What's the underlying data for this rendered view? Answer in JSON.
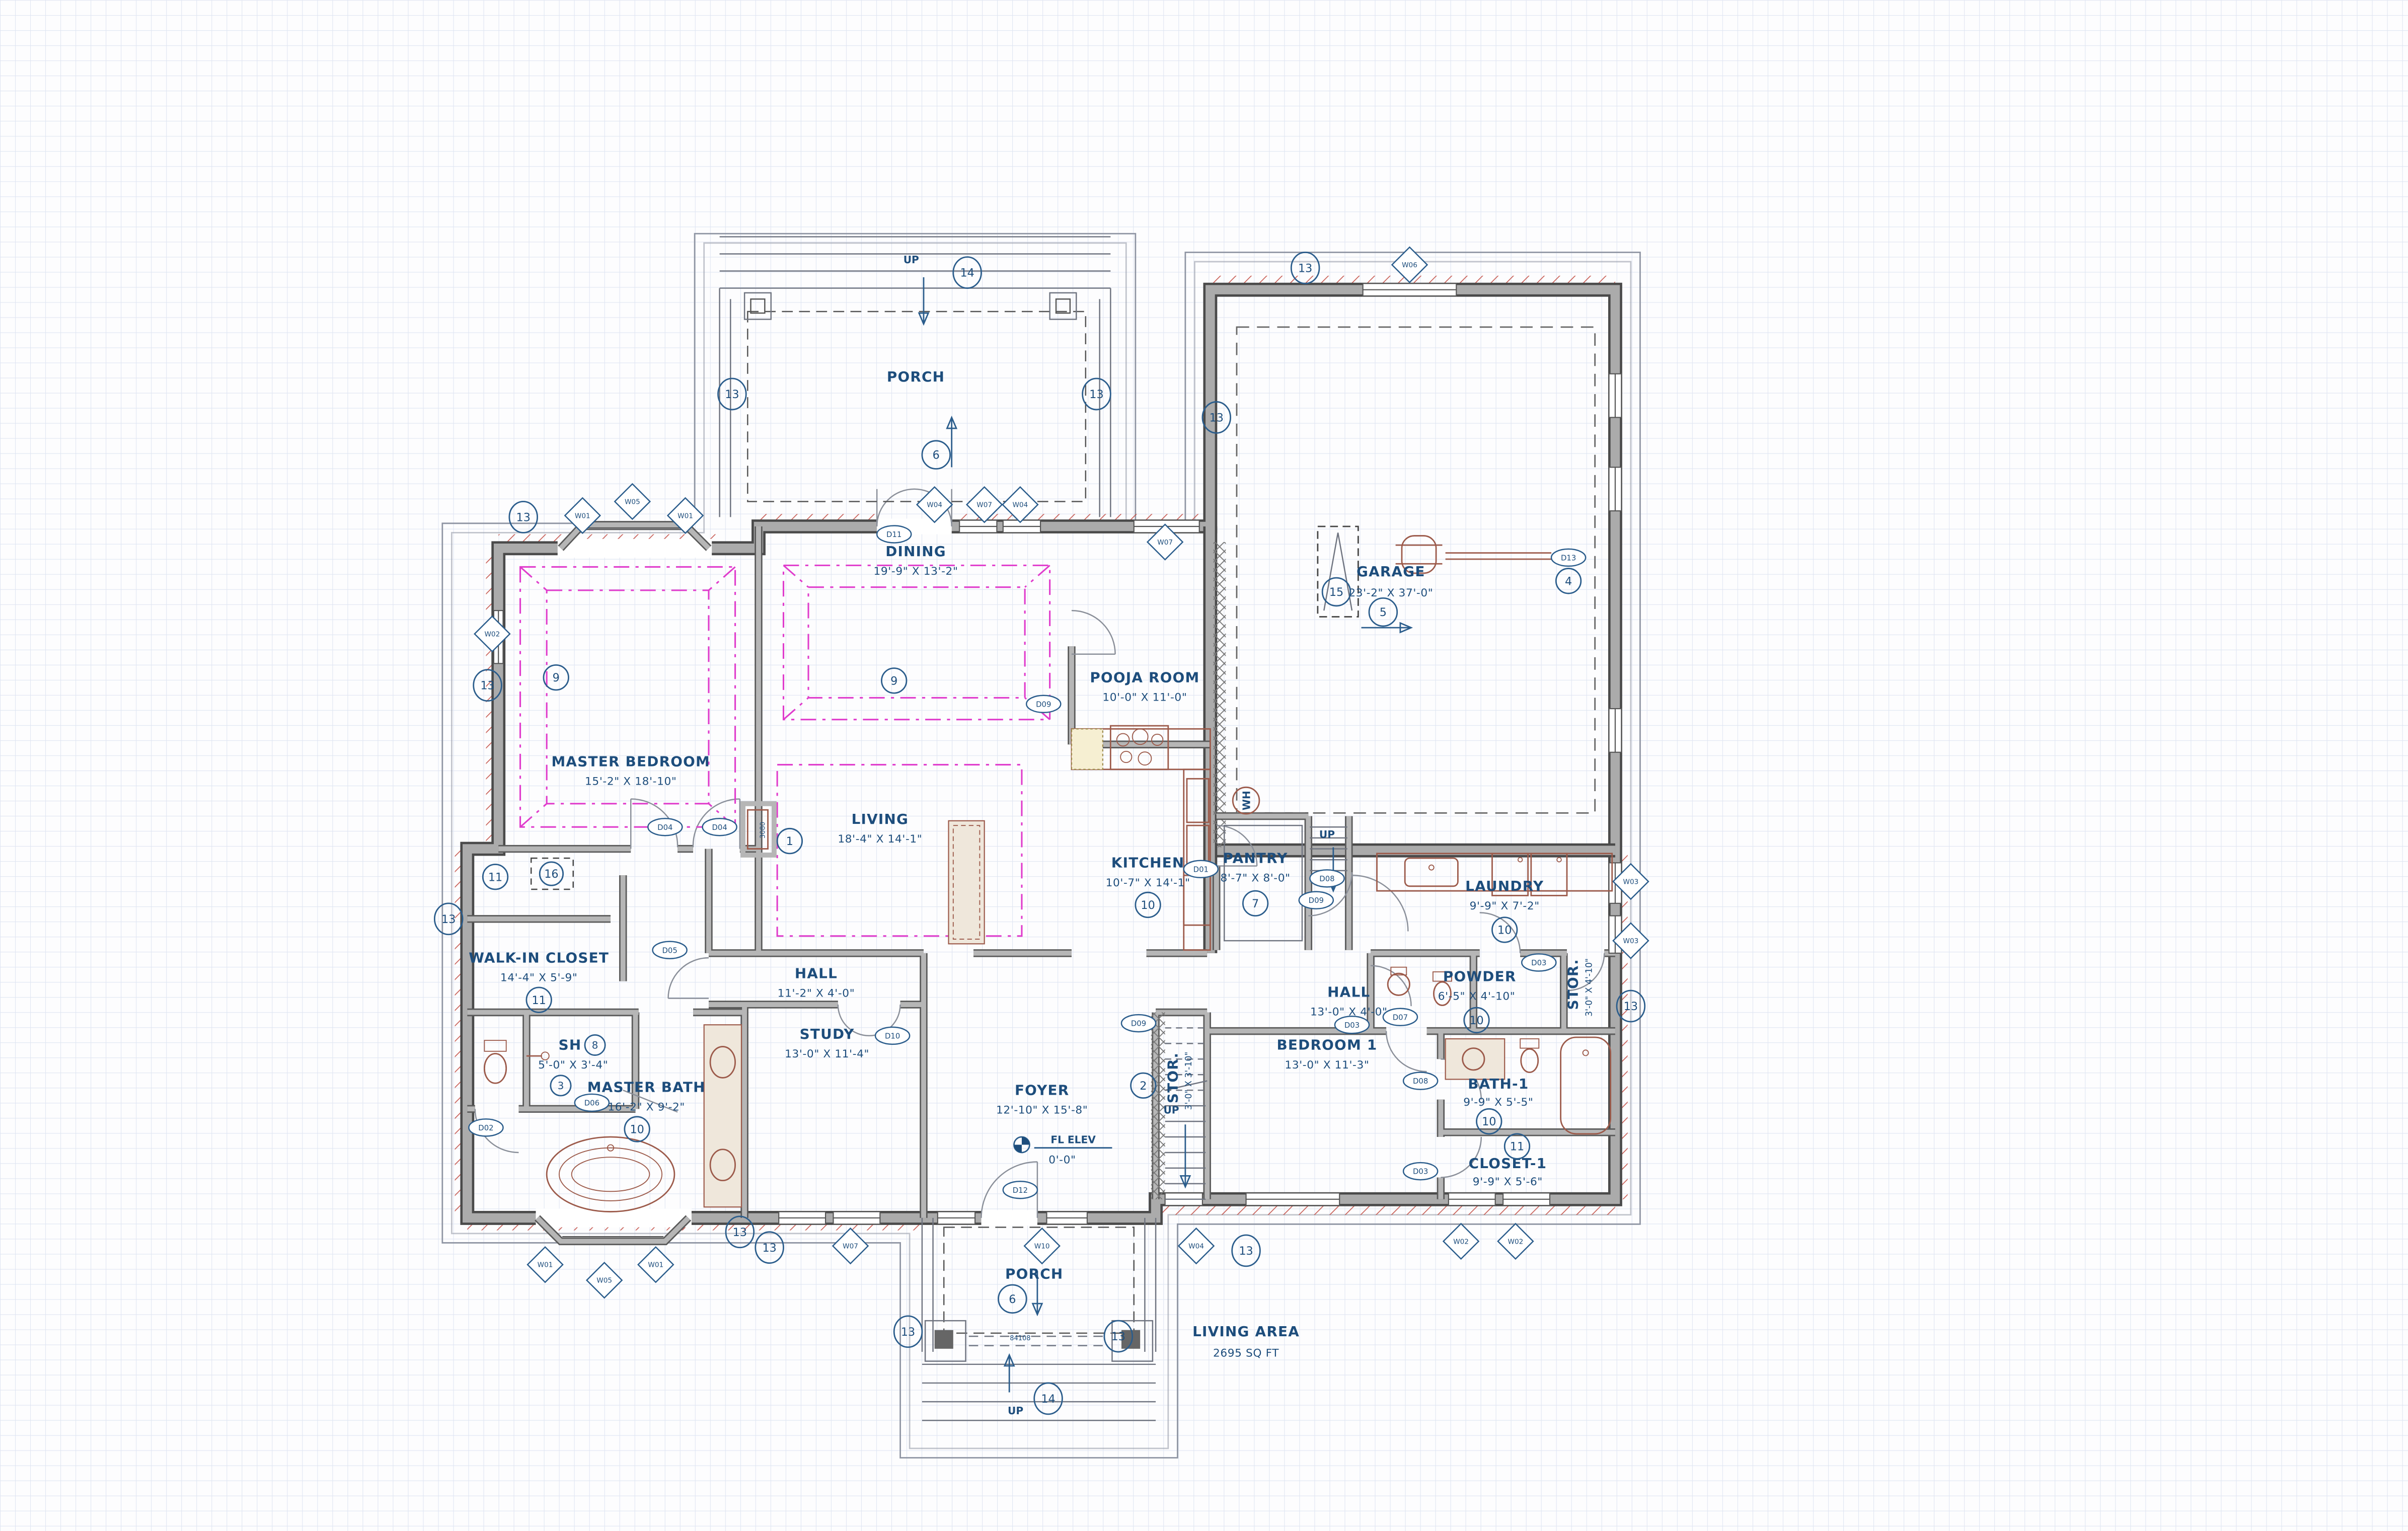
{
  "drawing": {
    "rooms": {
      "porch_top": {
        "name": "PORCH"
      },
      "dining": {
        "name": "DINING",
        "dims": "19'-9\" X 13'-2\""
      },
      "pooja": {
        "name": "POOJA ROOM",
        "dims": "10'-0\" X 11'-0\""
      },
      "garage": {
        "name": "GARAGE",
        "dims": "23'-2\" X 37'-0\""
      },
      "master_bedroom": {
        "name": "MASTER BEDROOM",
        "dims": "15'-2\" X 18'-10\""
      },
      "living": {
        "name": "LIVING",
        "dims": "18'-4\" X 14'-1\""
      },
      "kitchen": {
        "name": "KITCHEN",
        "dims": "10'-7\" X 14'-1\""
      },
      "pantry": {
        "name": "PANTRY",
        "dims": "8'-7\" X 8'-0\""
      },
      "laundry": {
        "name": "LAUNDRY",
        "dims": "9'-9\" X 7'-2\""
      },
      "walkin_closet": {
        "name": "WALK-IN CLOSET",
        "dims": "14'-4\" X 5'-9\""
      },
      "hall_left": {
        "name": "HALL",
        "dims": "11'-2\" X 4'-0\""
      },
      "hall_right": {
        "name": "HALL",
        "dims": "13'-0\" X 4'-0\""
      },
      "powder": {
        "name": "POWDER",
        "dims": "6'-5\" X 4'-10\""
      },
      "stor_right": {
        "name": "STOR.",
        "dims": "3'-0\" X 4'-10\""
      },
      "shower": {
        "name": "SH",
        "dims": "5'-0\" X 3'-4\""
      },
      "study": {
        "name": "STUDY",
        "dims": "13'-0\" X 11'-4\""
      },
      "master_bath": {
        "name": "MASTER BATH",
        "dims": "16'-2\" X 9'-2\""
      },
      "foyer": {
        "name": "FOYER",
        "dims": "12'-10\" X 15'-8\""
      },
      "bedroom1": {
        "name": "BEDROOM 1",
        "dims": "13'-0\" X 11'-3\""
      },
      "stor_stairs": {
        "name": "STOR.",
        "dims": "3'-0\" X 3'-10\""
      },
      "bath1": {
        "name": "BATH-1",
        "dims": "9'-9\" X 5'-5\""
      },
      "closet1": {
        "name": "CLOSET-1",
        "dims": "9'-9\" X 5'-6\""
      },
      "porch_bottom": {
        "name": "PORCH"
      }
    },
    "annotations": {
      "up": "UP",
      "fl_elev_label": "FL ELEV",
      "fl_elev_value": "0'-0\"",
      "living_area_label": "LIVING AREA",
      "living_area_value": "2695 SQ FT",
      "water_heater": "WH",
      "fireplace_width": "3080",
      "porch_step": "84108"
    },
    "ref_tags": {
      "t1": "1",
      "t2": "2",
      "t3": "3",
      "t4": "4",
      "t5": "5",
      "t6": "6",
      "t7": "7",
      "t8": "8",
      "t9": "9",
      "t10": "10",
      "t11": "11",
      "t13": "13",
      "t14": "14",
      "t15": "15",
      "t16": "16"
    },
    "door_tags": {
      "d01": "D01",
      "d02": "D02",
      "d03": "D03",
      "d04": "D04",
      "d05": "D05",
      "d06": "D06",
      "d07": "D07",
      "d08": "D08",
      "d09": "D09",
      "d10": "D10",
      "d11": "D11",
      "d12": "D12",
      "d13": "D13"
    },
    "window_tags": {
      "w01": "W01",
      "w02": "W02",
      "w03": "W03",
      "w04": "W04",
      "w05": "W05",
      "w06": "W06",
      "w07": "W07",
      "w10": "W10"
    },
    "colors": {
      "label_blue": "#1d4d7c",
      "wall_gray": "#ababab",
      "magenta": "#e03ccc",
      "hatch_red": "#c0443a",
      "fixture_brown": "#9c5a4a",
      "grid": "#dfe5f2"
    }
  }
}
